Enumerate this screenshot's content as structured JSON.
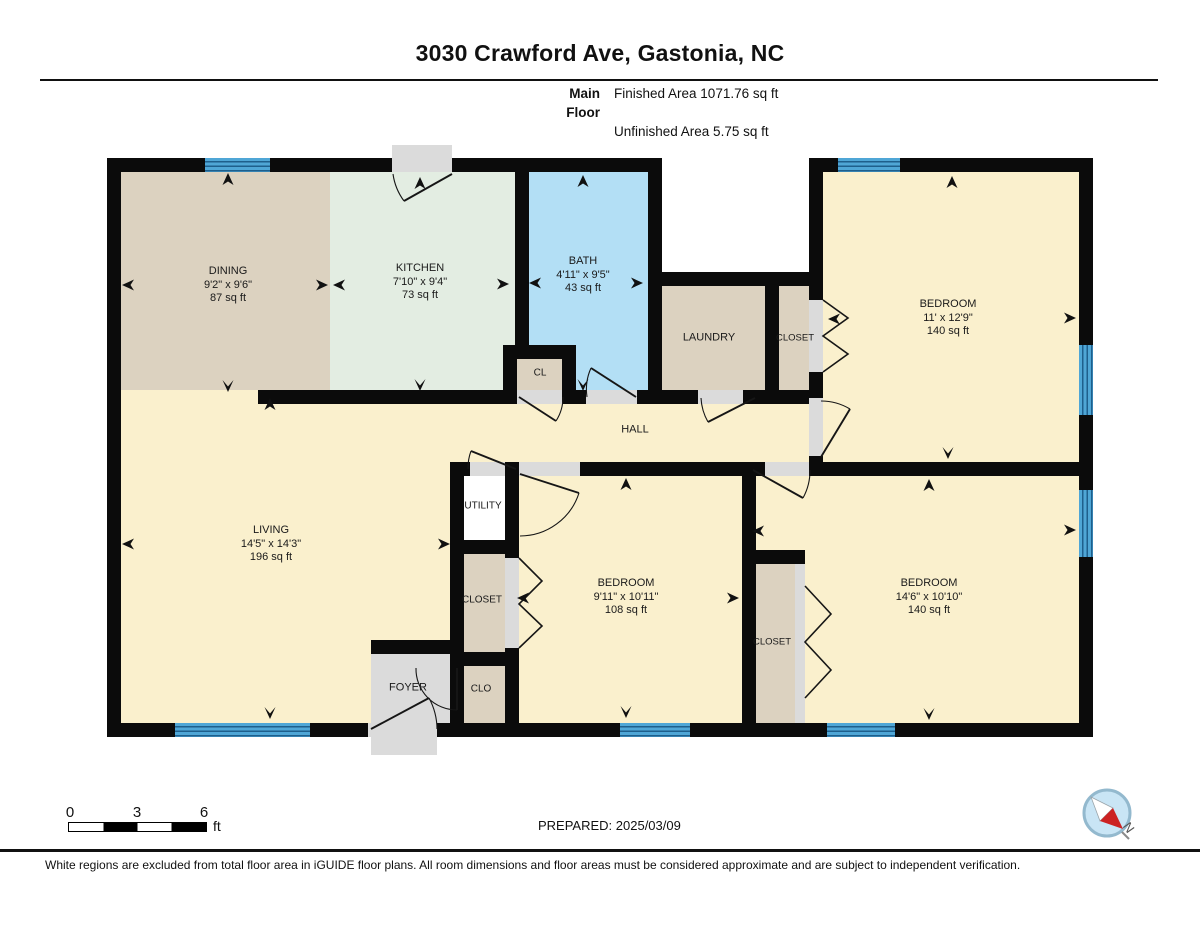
{
  "header": {
    "title": "3030 Crawford Ave, Gastonia, NC",
    "floor_label": "Main Floor",
    "finished_area": "Finished Area 1071.76 sq ft",
    "unfinished_area": "Unfinished Area 5.75 sq ft"
  },
  "rooms": {
    "dining": {
      "name": "DINING",
      "dims": "9'2\" x 9'6\"",
      "area": "87 sq ft"
    },
    "kitchen": {
      "name": "KITCHEN",
      "dims": "7'10\" x 9'4\"",
      "area": "73 sq ft"
    },
    "bath": {
      "name": "BATH",
      "dims": "4'11\" x 9'5\"",
      "area": "43 sq ft"
    },
    "laundry": {
      "name": "LAUNDRY"
    },
    "closet_top": {
      "name": "CLOSET"
    },
    "cl": {
      "name": "CL"
    },
    "bedroom_ne": {
      "name": "BEDROOM",
      "dims": "11' x 12'9\"",
      "area": "140 sq ft"
    },
    "hall": {
      "name": "HALL"
    },
    "living": {
      "name": "LIVING",
      "dims": "14'5\" x 14'3\"",
      "area": "196 sq ft"
    },
    "utility": {
      "name": "UTILITY"
    },
    "closet_mid": {
      "name": "CLOSET"
    },
    "bedroom_mid": {
      "name": "BEDROOM",
      "dims": "9'11\" x 10'11\"",
      "area": "108 sq ft"
    },
    "closet_se": {
      "name": "CLOSET"
    },
    "bedroom_se": {
      "name": "BEDROOM",
      "dims": "14'6\" x 10'10\"",
      "area": "140 sq ft"
    },
    "foyer": {
      "name": "FOYER"
    },
    "clo": {
      "name": "CLO"
    }
  },
  "scale_bar": {
    "ticks": [
      "0",
      "3",
      "6"
    ],
    "unit": "ft"
  },
  "prepared": "PREPARED: 2025/03/09",
  "compass": {
    "north_label": "N"
  },
  "footer": {
    "disclaimer": "White regions are excluded from total floor area in iGUIDE floor plans. All room dimensions and floor areas must be considered approximate and are subject to independent verification."
  },
  "colors": {
    "wall": "#0B0B0B",
    "finished_floor": "#FAF0CD",
    "tan_floor": "#DCD2C0",
    "kitchen_floor": "#E3EDE2",
    "bath_floor": "#B3DFF5",
    "window": "#4FA6D6",
    "window_line": "#1E5F8C",
    "exterior_gray": "#DBDBDB",
    "unfinished_white": "#FFFFFF",
    "compass_red": "#CC2222",
    "compass_blue": "#C9E5F5"
  }
}
